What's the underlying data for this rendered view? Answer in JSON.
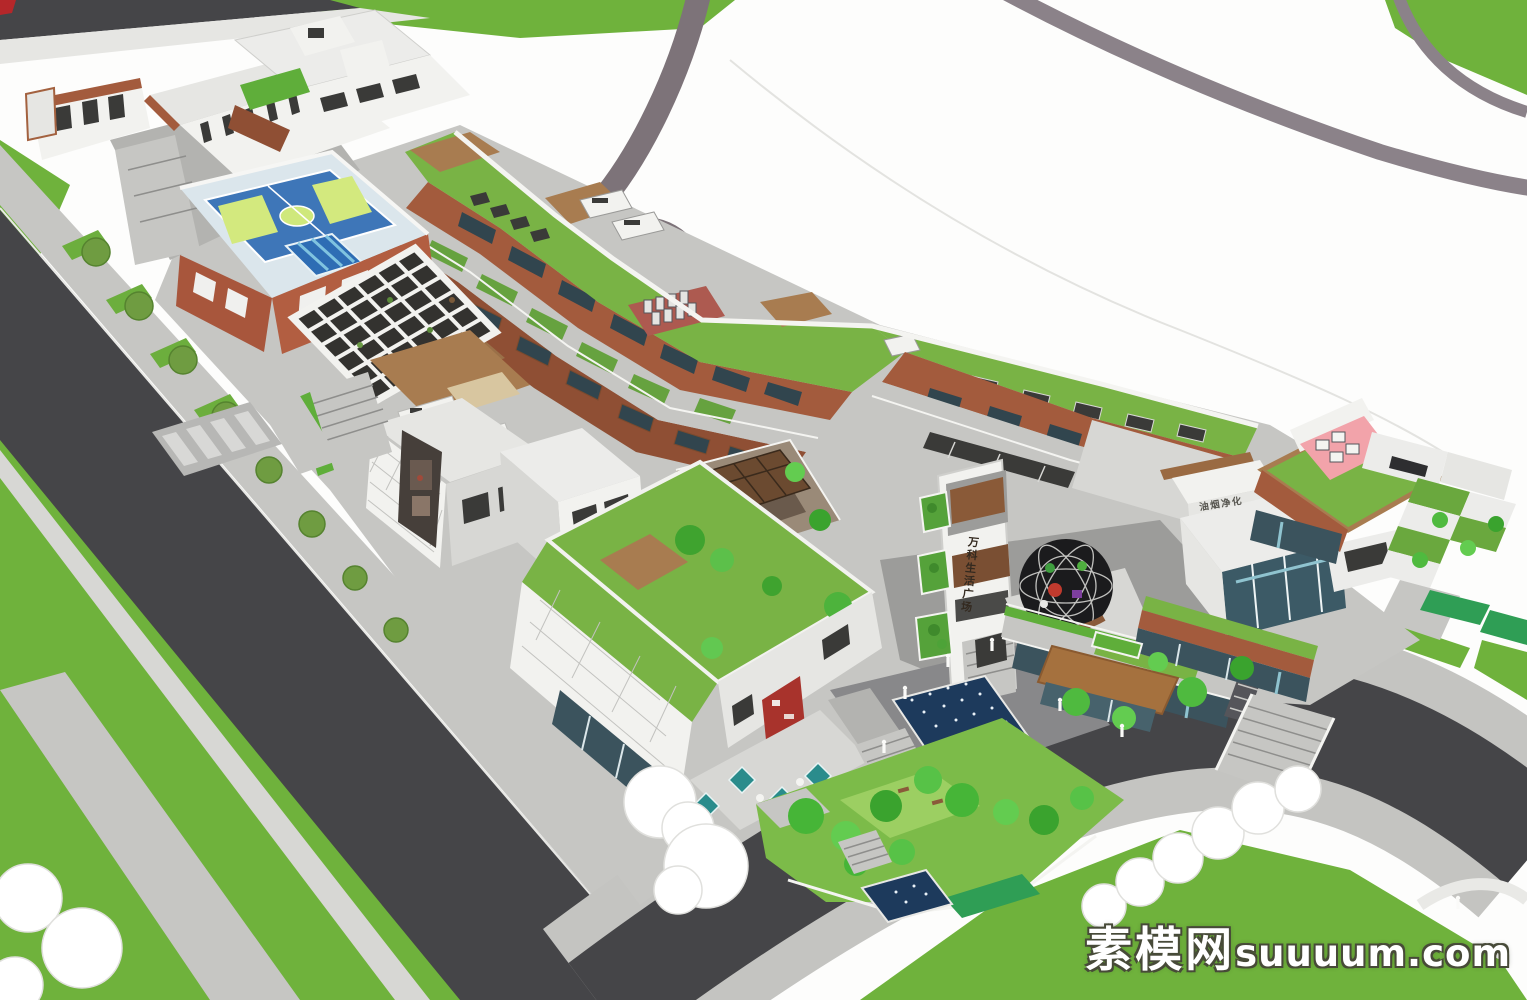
{
  "meta": {
    "subject": "Aerial 3D architectural rendering of a mixed-use commercial plaza complex (SketchUp style massing model)"
  },
  "watermark": {
    "site_name": "素模网",
    "site_domain": "suuuum.com"
  },
  "signs": {
    "tower_sign_vertical": "万科生活广场",
    "rooftop_equipment_label": "油烟净化"
  },
  "palette": {
    "lawn_green": "#6fb23c",
    "roof_green": "#79b345",
    "asphalt_dark": "#454548",
    "road_mauve": "#7d7379",
    "sidewalk_grey": "#c4c4c1",
    "plaza_grey": "#a3a3a1",
    "wall_white": "#f2f2ef",
    "brick_red": "#a8563c",
    "wood_brown": "#a87c50",
    "fascia_brown": "#a35b3d",
    "glass_teal": "#3b535d",
    "court_blue": "#3e76b8",
    "court_green": "#d3e97e",
    "pool_blue": "#2e6db4",
    "deck_pink": "#f2a3aa",
    "umbrella_teal": "#2a8c8c",
    "water_navy": "#1d3a5c",
    "dome_black": "#1b1b1d",
    "tree_bright_green": "#4fba3f",
    "tree_olive_green": "#6e9c40",
    "watermark_white": "#ffffff",
    "corner_mark_red": "#b5272a"
  }
}
